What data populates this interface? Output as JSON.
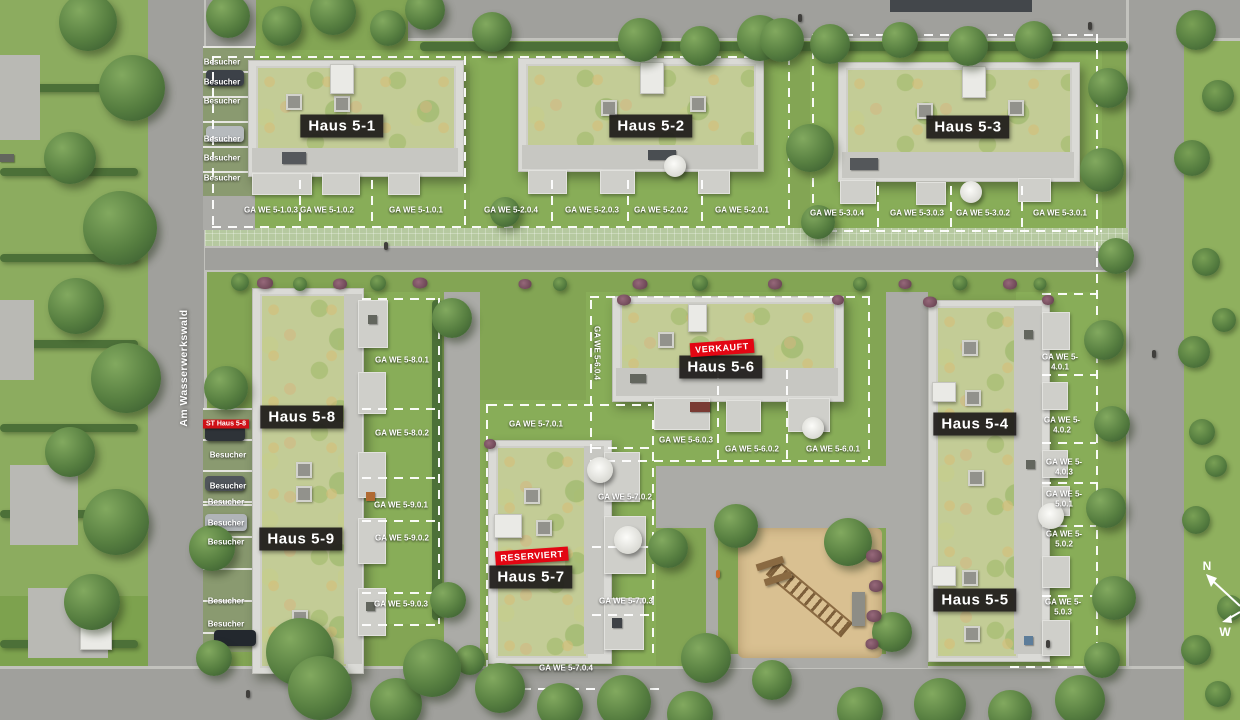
{
  "site": {
    "street_name": "Am Wasserwerkswald",
    "visitor_label": "Besucher",
    "st_label": "ST Haus 5-8"
  },
  "compass": {
    "n": "N",
    "w": "W"
  },
  "colors": {
    "status_red": "#e30613",
    "label_dark": "#1e1b1a",
    "roof_green": "#c3cc96"
  },
  "houses": {
    "h1": {
      "name": "Haus 5-1"
    },
    "h2": {
      "name": "Haus 5-2"
    },
    "h3": {
      "name": "Haus 5-3"
    },
    "h4": {
      "name": "Haus 5-4"
    },
    "h5": {
      "name": "Haus 5-5"
    },
    "h6": {
      "name": "Haus 5-6",
      "status": "VERKAUFT"
    },
    "h7": {
      "name": "Haus 5-7",
      "status": "RESERVIERT"
    },
    "h8": {
      "name": "Haus 5-8"
    },
    "h9": {
      "name": "Haus 5-9"
    }
  },
  "gardens": {
    "h1": [
      "GA WE 5-1.0.3",
      "GA WE 5-1.0.2",
      "GA WE 5-1.0.1"
    ],
    "h2": [
      "GA WE 5-2.0.4",
      "GA WE 5-2.0.3",
      "GA WE 5-2.0.2",
      "GA WE 5-2.0.1"
    ],
    "h3": [
      "GA WE 5-3.0.4",
      "GA WE 5-3.0.3",
      "GA WE 5-3.0.2",
      "GA WE 5-3.0.1"
    ],
    "h4": [
      "GA WE 5-4.0.1",
      "GA WE 5-4.0.2",
      "GA WE 5-4.0.3"
    ],
    "h5": [
      "GA WE 5-5.0.1",
      "GA WE 5-5.0.2",
      "GA WE 5-5.0.3"
    ],
    "h6": [
      "GA WE 5-6.0.4",
      "GA WE 5-6.0.3",
      "GA WE 5-6.0.2",
      "GA WE 5-6.0.1"
    ],
    "h7": [
      "GA WE 5-7.0.1",
      "GA WE 5-7.0.2",
      "GA WE 5-7.0.3",
      "GA WE 5-7.0.4"
    ],
    "h8": [
      "GA WE 5-8.0.1",
      "GA WE 5-8.0.2"
    ],
    "h9": [
      "GA WE 5-9.0.1",
      "GA WE 5-9.0.2",
      "GA WE 5-9.0.3"
    ]
  }
}
